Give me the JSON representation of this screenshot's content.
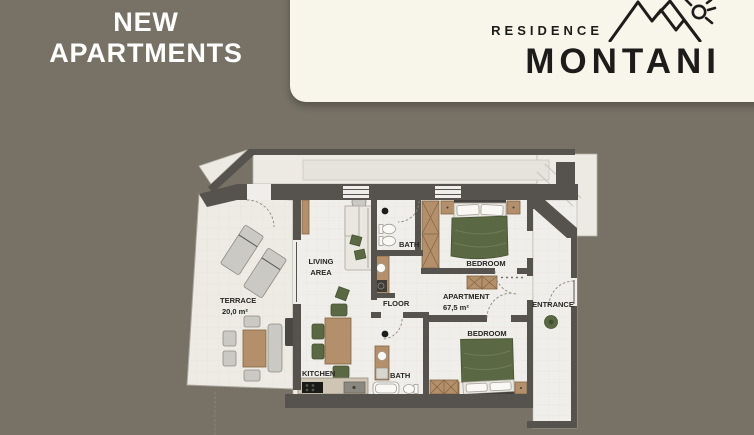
{
  "headline": {
    "line1": "NEW",
    "line2": "APARTMENTS"
  },
  "brand": {
    "subtitle": "RESIDENCE",
    "title": "MONTANI",
    "logo_icon": "mountain-sun-icon"
  },
  "plan": {
    "labels": {
      "terrace_name": "TERRACE",
      "terrace_area": "20,0 m²",
      "living_line1": "LIVING",
      "living_line2": "AREA",
      "kitchen": "KITCHEN",
      "bath_top": "BATH",
      "bath_bottom": "BATH",
      "floor": "FLOOR",
      "apartment_name": "APARTMENT",
      "apartment_area": "67,5 m²",
      "bedroom_top": "BEDROOM",
      "bedroom_bottom": "BEDROOM",
      "entrance": "ENTRANCE"
    }
  },
  "colors": {
    "background": "#787266",
    "card": "#f8f5ea",
    "ink": "#1d1c1a",
    "headline": "#ffffff",
    "wall": "#56534e",
    "floor": "#f0eeea",
    "green": "#5a6944",
    "wood": "#b3906b"
  }
}
